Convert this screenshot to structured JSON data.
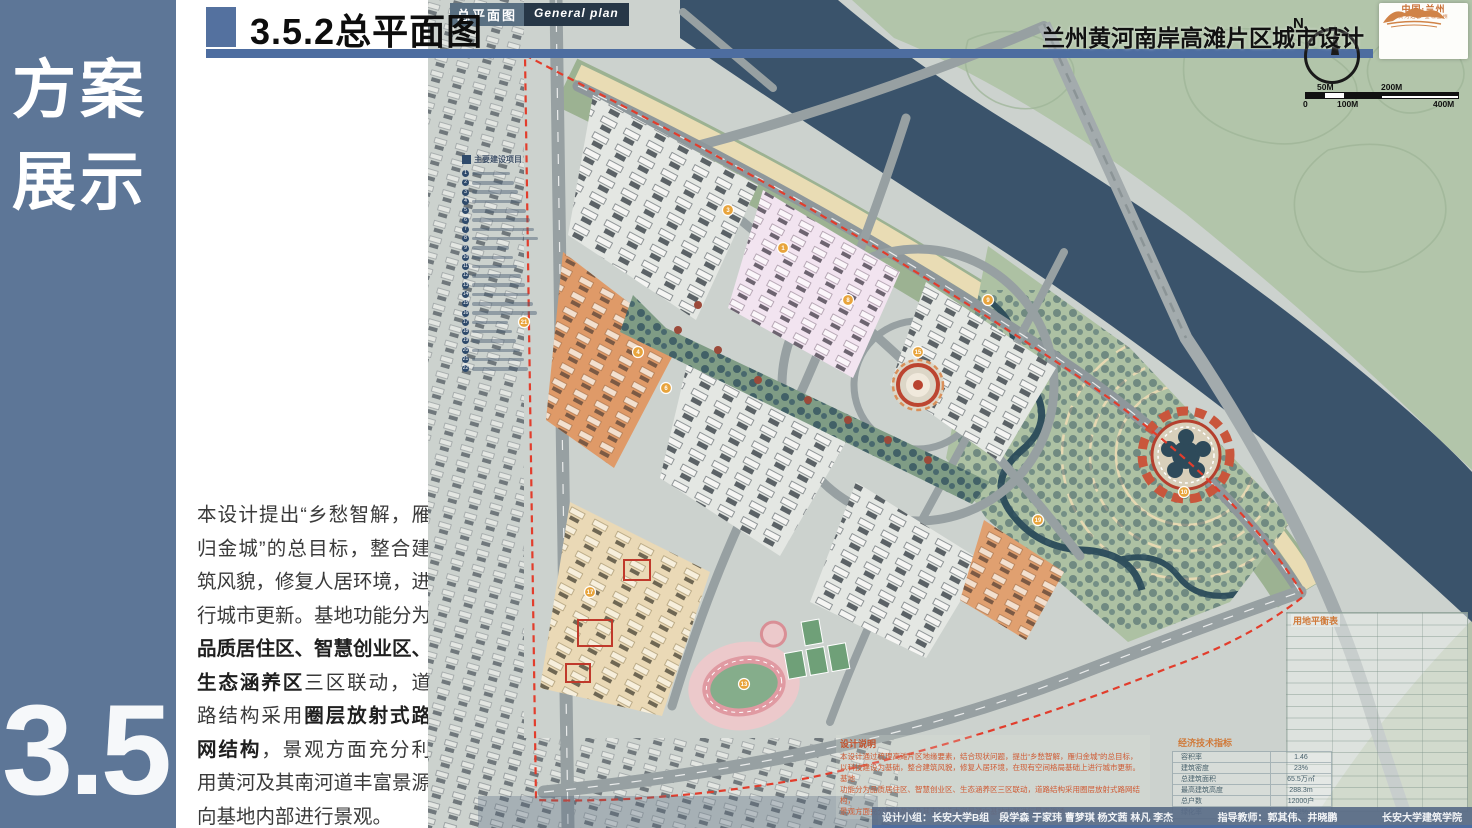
{
  "sidebar": {
    "title_top": "方案",
    "title_bottom": "展示",
    "section_number": "3.5"
  },
  "header": {
    "title": "3.5.2总平面图",
    "project_title": "兰州黄河南岸高滩片区城市设计",
    "accent_color": "#4d6da0"
  },
  "description": {
    "seg1": "本设计提出“乡愁智解，雁归金城”的总目标，整合建筑风貌，修复人居环境，进行城市更新。基地功能分为",
    "seg2_bold": "品质居住区、智慧创业区、生态涵养区",
    "seg3": "三区联动，道路结构采用",
    "seg4_bold": "圈层放射式路网结构",
    "seg5": "，景观方面充分利用黄河及其南河道丰富景源向基地内部进行景观。"
  },
  "map_overlay": {
    "label_cn": "总平面图",
    "label_en": "General plan",
    "compass_letter": "N",
    "logo": {
      "line1": "中国·兰州",
      "line2": "黄河之都 金城兰州"
    },
    "scale_bar": {
      "top_labels": [
        "50M",
        "200M"
      ],
      "bottom_labels": [
        "0",
        "100M",
        "400M"
      ]
    },
    "legend": {
      "title": "主要建设项目",
      "count": 22
    },
    "design_note": {
      "title": "设计说明",
      "lines": [
        "本设计通过梳理高滩片区地缘要素，结合现状问题，提出“乡愁智解，雁归金城”的总目标，",
        "以科技建设为基础，整合建筑风貌，修复人居环境，在现有空间格局基础上进行城市更新。基地",
        "功能分为品质居住区、智慧创业区、生态涵养区三区联动，道路结构采用圈层放射式路网结构，",
        "景观方面充分利用黄河及其南河道丰富景源向基地内部进行景观渗透。"
      ]
    },
    "land_use_table": {
      "title": "用地平衡表"
    },
    "econ_table": {
      "title": "经济技术指标",
      "rows": [
        [
          "容积率",
          "1.46"
        ],
        [
          "建筑密度",
          "23%"
        ],
        [
          "总建筑面积",
          "65.5万㎡"
        ],
        [
          "最高建筑高度",
          "288.3m"
        ],
        [
          "总户数",
          "12000户"
        ],
        [
          "绿化率",
          "42%"
        ]
      ]
    },
    "badges": [
      {
        "n": "1",
        "x": 355,
        "y": 248
      },
      {
        "n": "3",
        "x": 300,
        "y": 210
      },
      {
        "n": "4",
        "x": 210,
        "y": 352
      },
      {
        "n": "6",
        "x": 238,
        "y": 388
      },
      {
        "n": "8",
        "x": 420,
        "y": 300
      },
      {
        "n": "9",
        "x": 560,
        "y": 300
      },
      {
        "n": "13",
        "x": 316,
        "y": 684
      },
      {
        "n": "15",
        "x": 490,
        "y": 352
      },
      {
        "n": "10",
        "x": 756,
        "y": 492
      },
      {
        "n": "17",
        "x": 162,
        "y": 592
      },
      {
        "n": "19",
        "x": 610,
        "y": 520
      },
      {
        "n": "21",
        "x": 96,
        "y": 322
      }
    ],
    "colors": {
      "river": "#3a536b",
      "hills": "#b2c5aa",
      "park": "#adc1a3",
      "promenade": "#e9dcb4",
      "boundary_red": "#e23d2c"
    }
  },
  "footer": {
    "team": "设计小组：长安大学B组　段学森 于家玮 曹梦琪 杨文茜 林凡 李杰",
    "advisors": "指导教师：郭其伟、井晓鹏",
    "school": "长安大学建筑学院"
  }
}
